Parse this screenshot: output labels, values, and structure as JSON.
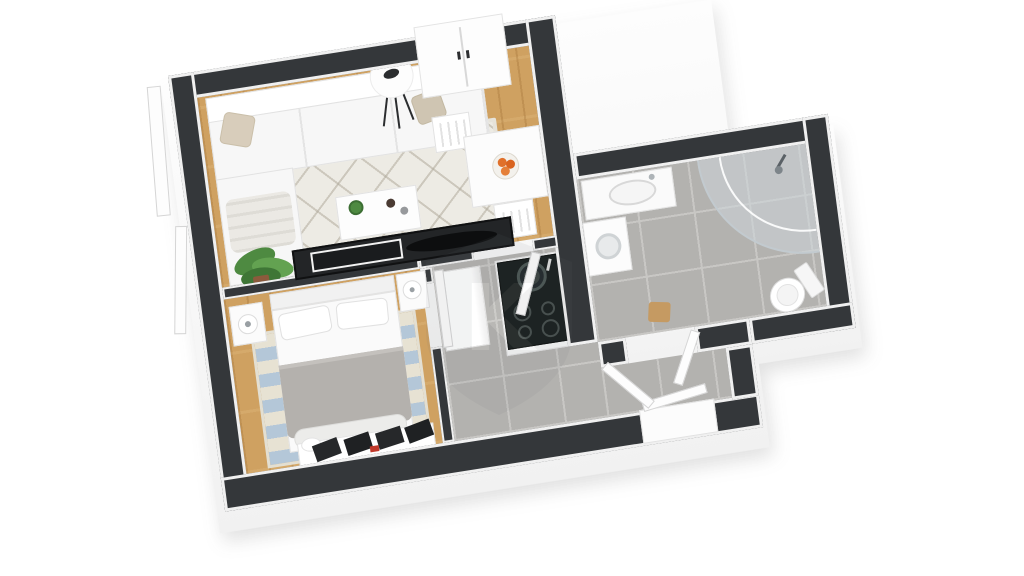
{
  "app": {
    "type": "3d-floor-plan-render",
    "background": "#ffffff"
  },
  "watermark": {
    "letter": "K"
  },
  "palette": {
    "wall_top": "#34373a",
    "wall_side": "#fdfdfd",
    "wood_floor": "#cfa161",
    "tile_floor": "#b3b2af",
    "living_rug": "#edebe4",
    "bedroom_rug_blue": "#b4c7d8",
    "bedroom_rug_cream": "#e7e2d3",
    "bed_blanket": "#b4b1ad",
    "black_furniture": "#232527",
    "oranges": "#e0702a",
    "plant_green": "#4e8a41",
    "counter_top": "#171d1c"
  },
  "rooms": [
    {
      "name": "living-room",
      "floor": "wood",
      "furniture": [
        "corner-sofa",
        "throw-pillow-left",
        "throw-pillow-right",
        "sofa-blanket",
        "area-rug",
        "coffee-table",
        "coffee-table-plant",
        "floor-lamp",
        "tv-console",
        "tv",
        "wardrobe",
        "potted-plant",
        "dining-table",
        "fruit-bowl-oranges",
        "dining-chair-top",
        "dining-chair-bottom",
        "window-frames"
      ]
    },
    {
      "name": "bedroom",
      "floor": "wood",
      "furniture": [
        "double-bed",
        "bed-pillows",
        "striped-rug",
        "nightstand-left",
        "nightstand-right",
        "table-lamp-left",
        "table-lamp-right",
        "dresser",
        "dresser-items"
      ]
    },
    {
      "name": "kitchen",
      "floor": "tile",
      "furniture": [
        "kitchen-counter",
        "black-countertop",
        "round-sink",
        "cooktop-burners",
        "tall-cabinet"
      ]
    },
    {
      "name": "hallway",
      "floor": "tile",
      "furniture": [
        "hall-door",
        "bedroom-door"
      ]
    },
    {
      "name": "bathroom",
      "floor": "tile",
      "furniture": [
        "corner-glass-shower",
        "shower-head",
        "washbasin-vanity",
        "washing-machine",
        "toilet",
        "bath-stool",
        "bathroom-door"
      ]
    },
    {
      "name": "vestibule",
      "floor": "tile",
      "furniture": [
        "entrance-mat",
        "entry-door-leaf",
        "vestibule-door"
      ]
    }
  ]
}
